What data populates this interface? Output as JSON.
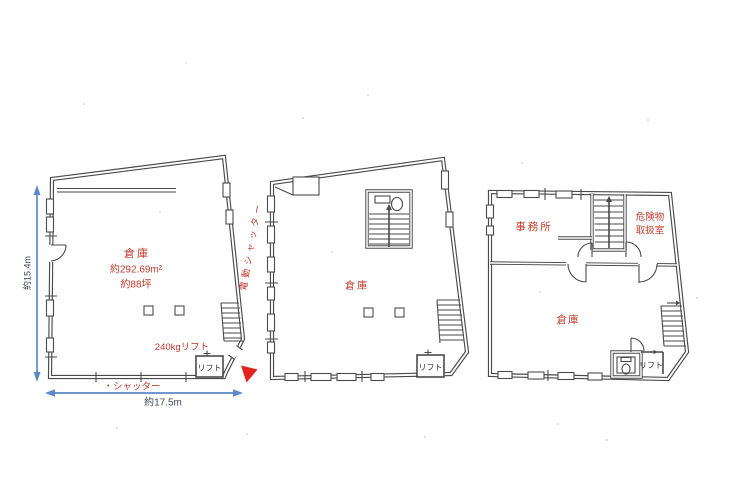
{
  "colors": {
    "line": "#4a4a4a",
    "red": "#c03a2b",
    "blue": "#5b8ac6",
    "dim": "#3d4758",
    "arrow": "#e2231a"
  },
  "plans": {
    "left": {
      "room": "倉庫",
      "area_m2": "約292.69m²",
      "area_tsubo": "約88坪",
      "lift_capacity": "240kgリフト",
      "lift": "リフト",
      "shutter": "・シャッター",
      "electric_shutter": "電動シャッター",
      "dim_width": "約17.5m",
      "dim_height": "約15.4m"
    },
    "middle": {
      "room": "倉庫",
      "lift": "リフト"
    },
    "right": {
      "office": "事務所",
      "hazmat1": "危険物",
      "hazmat2": "取扱室",
      "room": "倉庫",
      "lift": "リフト"
    }
  }
}
